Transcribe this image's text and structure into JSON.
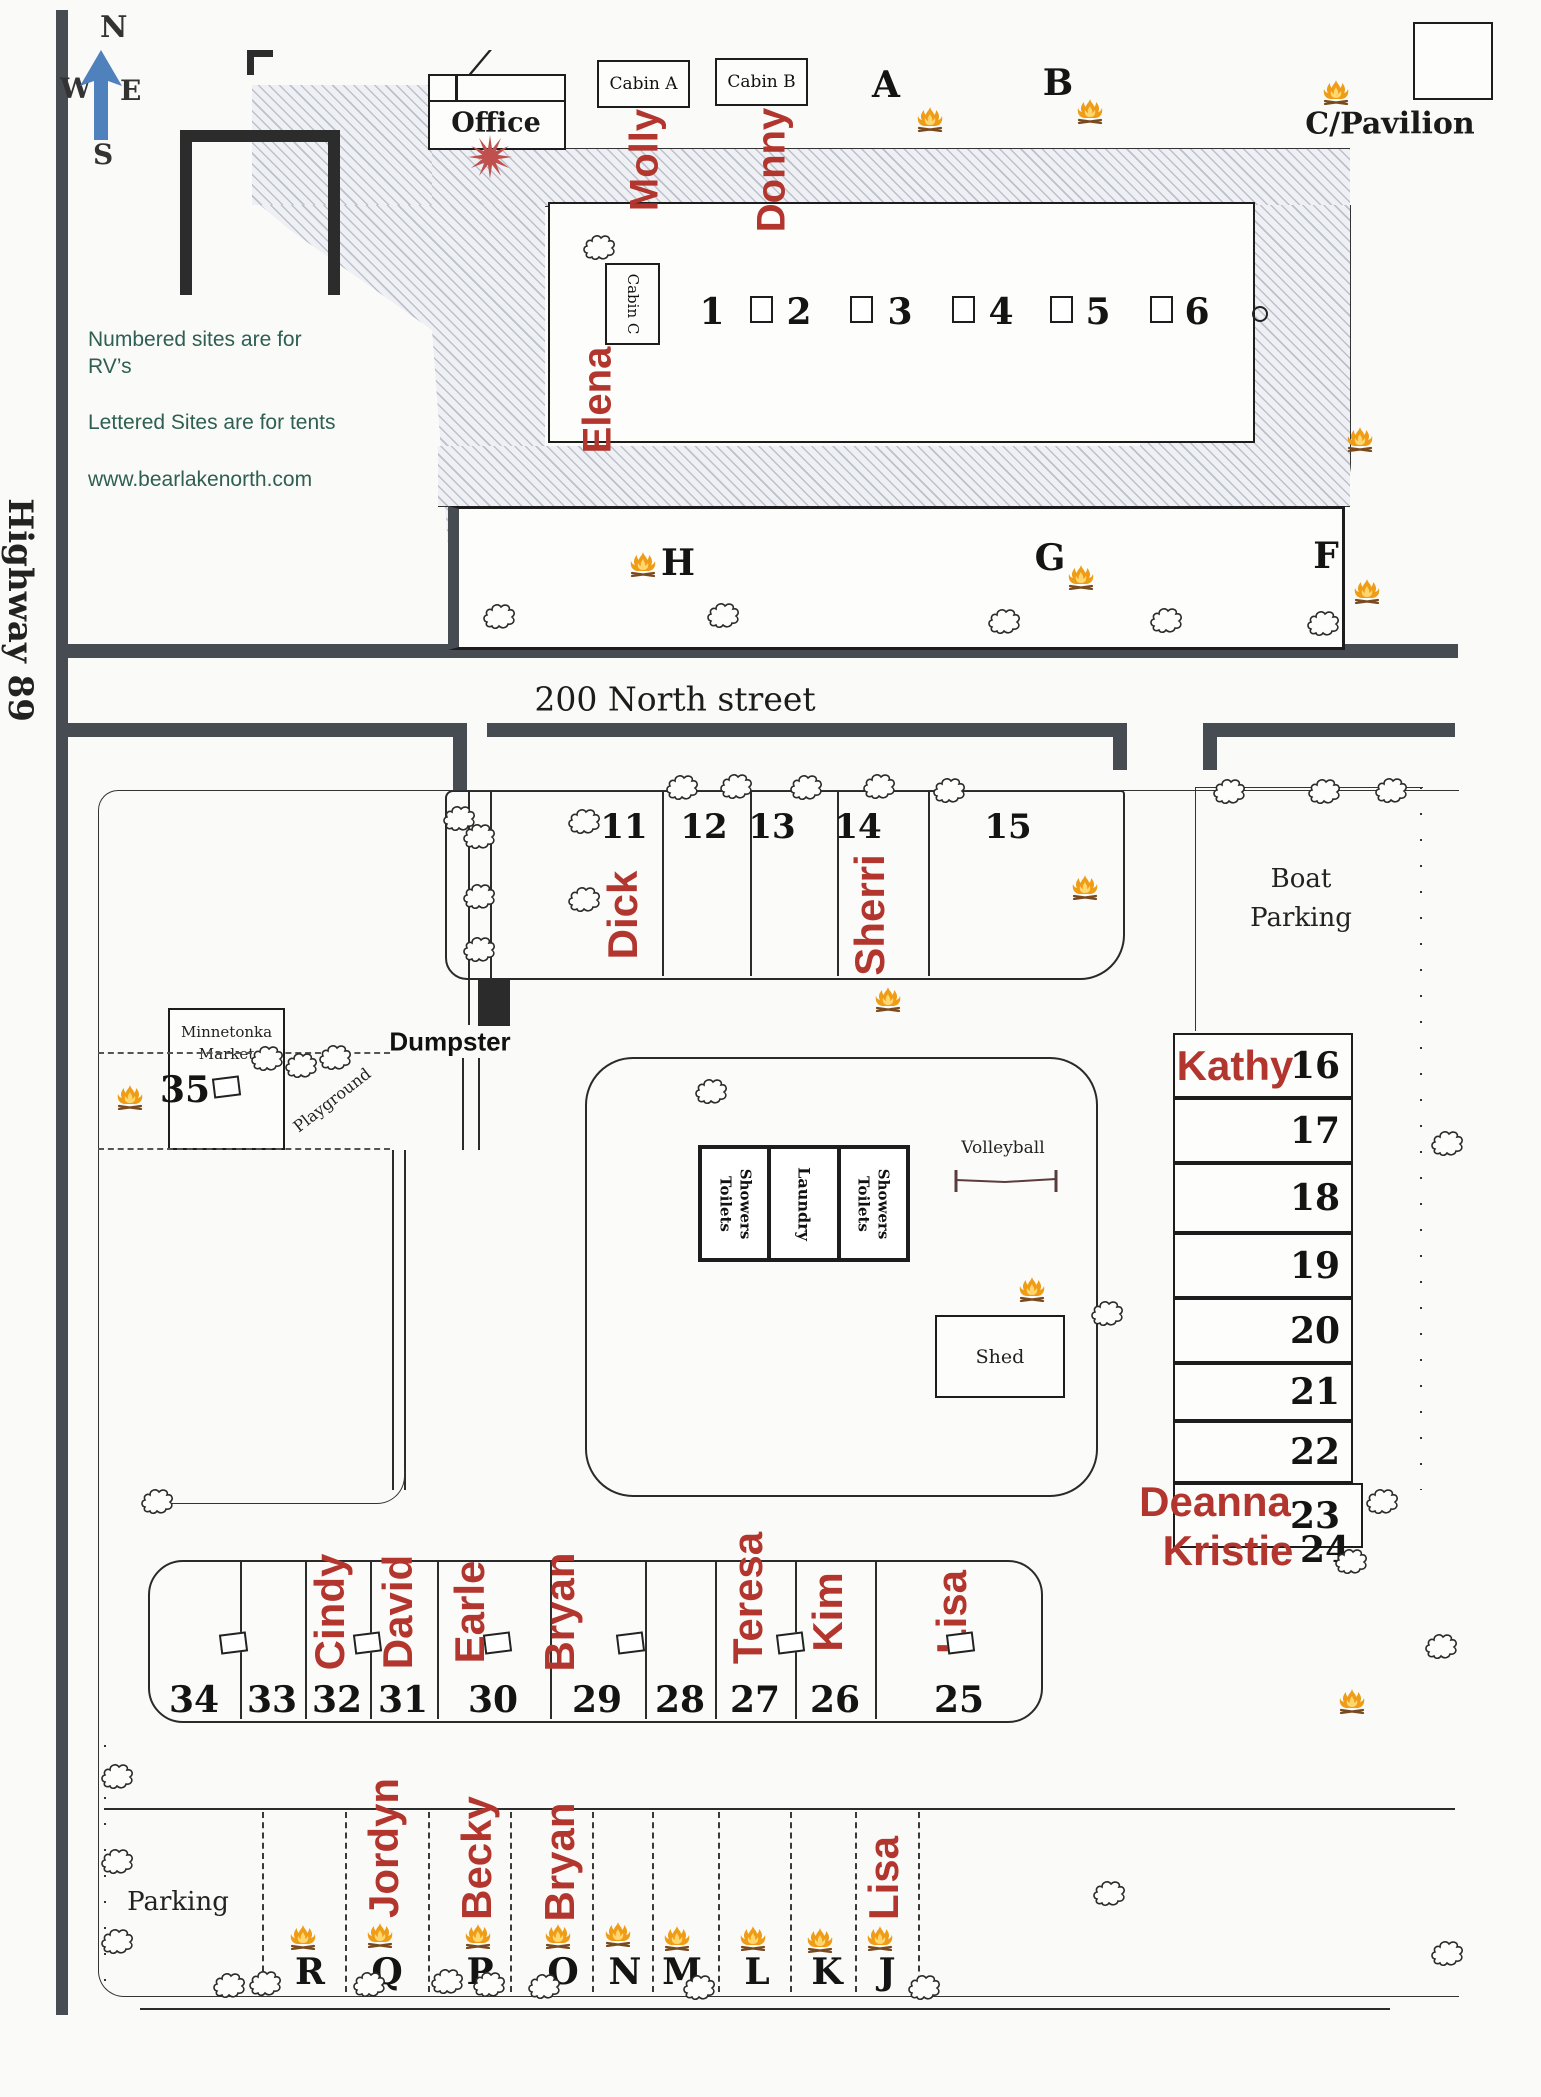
{
  "title": "Bear Lake North campground site map",
  "legend": {
    "line1": "Numbered sites are for RV’s",
    "line2": "Lettered Sites are for tents",
    "website": "www.bearlakenorth.com"
  },
  "compass": {
    "n": "N",
    "s": "S",
    "e": "E",
    "w": "W"
  },
  "roads": {
    "highway": "Highway 89",
    "street": "200 North street"
  },
  "labels": {
    "office": "Office",
    "cabin_a": "Cabin A",
    "cabin_b": "Cabin B",
    "cabin_c": "Cabin C",
    "pavilion": "C/Pavilion",
    "boat1": "Boat",
    "boat2": "Parking",
    "market1": "Minnetonka",
    "market2": "Market",
    "dumpster": "Dumpster",
    "laundry": "Laundry",
    "showers1": "Showers",
    "showers2": "Toilets",
    "volleyball": "Volleyball",
    "shed": "Shed",
    "parking": "Parking",
    "playground": "Playground",
    "site35": "35"
  },
  "colors": {
    "red_name": "#b2362e",
    "starburst": "#c0504d",
    "road_bar": "#474c52",
    "teal_text": "#2e5f52",
    "fire_orange": "#ef9c16",
    "compass_blue": "#4f81bd"
  },
  "cabin_guests": [
    {
      "label": "Molly",
      "x": 645,
      "y": 160
    },
    {
      "label": "Donny",
      "x": 772,
      "y": 170
    },
    {
      "label": "Elena",
      "x": 598,
      "y": 400
    }
  ],
  "rv_sites_1_6": {
    "box": [
      548,
      202,
      1255,
      443
    ],
    "num_y": 312,
    "sites": [
      {
        "num": "1",
        "x": 712
      },
      {
        "num": "2",
        "x": 799,
        "pad_x": 761
      },
      {
        "num": "3",
        "x": 900,
        "pad_x": 861
      },
      {
        "num": "4",
        "x": 1001,
        "pad_x": 963
      },
      {
        "num": "5",
        "x": 1098,
        "pad_x": 1061
      },
      {
        "num": "6",
        "x": 1197,
        "pad_x": 1161
      }
    ],
    "circle_x": 1258
  },
  "tent_sites_top": [
    {
      "letter": "A",
      "x": 886,
      "y": 85
    },
    {
      "letter": "B",
      "x": 1058,
      "y": 83
    }
  ],
  "tent_sites_mid": [
    {
      "letter": "H",
      "x": 678,
      "y": 563
    },
    {
      "letter": "G",
      "x": 1050,
      "y": 558
    },
    {
      "letter": "F",
      "x": 1326,
      "y": 556
    }
  ],
  "rv_strip_11_15": {
    "box": [
      445,
      790,
      1125,
      980
    ],
    "dividers": [
      662,
      750,
      837,
      928
    ],
    "num_y": 827,
    "sites": [
      {
        "num": "11",
        "x": 624,
        "name": "Dick",
        "name_x": 623,
        "name_y": 915
      },
      {
        "num": "12",
        "x": 704
      },
      {
        "num": "13",
        "x": 772
      },
      {
        "num": "14",
        "x": 858,
        "name": "Sherri",
        "name_x": 870,
        "name_y": 915
      },
      {
        "num": "15",
        "x": 1008
      }
    ]
  },
  "rv_right_column": {
    "x1": 1173,
    "x2": 1353,
    "num_x": 1315,
    "sites": [
      {
        "num": "16",
        "y1": 1033,
        "y2": 1098,
        "name": "Kathy",
        "name_x": 1235,
        "name_y": 1066
      },
      {
        "num": "17",
        "y1": 1098,
        "y2": 1163
      },
      {
        "num": "18",
        "y1": 1163,
        "y2": 1233
      },
      {
        "num": "19",
        "y1": 1233,
        "y2": 1298
      },
      {
        "num": "20",
        "y1": 1298,
        "y2": 1363
      },
      {
        "num": "21",
        "y1": 1363,
        "y2": 1421
      },
      {
        "num": "22",
        "y1": 1421,
        "y2": 1483
      },
      {
        "num": "23",
        "y1": 1483,
        "y2": 1548,
        "x2": 1363,
        "name": "Deanna",
        "name_x": 1215,
        "name_y": 1502
      },
      {
        "num": "24",
        "nobox": true,
        "num_x": 1325,
        "num_y": 1550,
        "name": "Kristie",
        "name_x": 1228,
        "name_y": 1551
      }
    ]
  },
  "rv_row_25_34": {
    "box": [
      148,
      1560,
      1043,
      1723
    ],
    "dividers": [
      240,
      305,
      370,
      437,
      550,
      645,
      715,
      795,
      875
    ],
    "num_y": 1700,
    "name_y": 1612,
    "sites": [
      {
        "num": "34",
        "x": 194
      },
      {
        "num": "33",
        "x": 272
      },
      {
        "num": "32",
        "x": 337,
        "name": "Cindy",
        "name_x": 330
      },
      {
        "num": "31",
        "x": 403,
        "name": "David",
        "name_x": 398
      },
      {
        "num": "30",
        "x": 493,
        "name": "Earle",
        "name_x": 470
      },
      {
        "num": "29",
        "x": 597,
        "name": "Bryan",
        "name_x": 560
      },
      {
        "num": "28",
        "x": 680
      },
      {
        "num": "27",
        "x": 755,
        "name": "Teresa",
        "name_x": 748,
        "name_y": 1598
      },
      {
        "num": "26",
        "x": 835,
        "name": "Kim",
        "name_x": 828
      },
      {
        "num": "25",
        "x": 959,
        "name": "Lisa",
        "name_x": 952
      }
    ],
    "posts": [
      [
        233,
        1643
      ],
      [
        367,
        1643
      ],
      [
        497,
        1643
      ],
      [
        630,
        1643
      ],
      [
        790,
        1643
      ],
      [
        960,
        1643
      ]
    ]
  },
  "tent_row_bottom": {
    "letter_y": 1972,
    "dividers": [
      262,
      345,
      428,
      510,
      592,
      652,
      718,
      790,
      855,
      918
    ],
    "sites": [
      {
        "letter": "R",
        "x": 310
      },
      {
        "letter": "Q",
        "x": 387,
        "name": "Jordyn",
        "name_y": 1848
      },
      {
        "letter": "P",
        "x": 480,
        "name": "Becky",
        "name_y": 1858
      },
      {
        "letter": "O",
        "x": 563,
        "name": "Bryan",
        "name_y": 1862
      },
      {
        "letter": "N",
        "x": 625
      },
      {
        "letter": "M",
        "x": 682
      },
      {
        "letter": "L",
        "x": 757
      },
      {
        "letter": "K",
        "x": 827
      },
      {
        "letter": "J",
        "x": 887,
        "name": "Lisa",
        "name_y": 1878
      }
    ]
  },
  "campfires": [
    [
      930,
      120
    ],
    [
      1090,
      112
    ],
    [
      1336,
      93
    ],
    [
      643,
      565
    ],
    [
      1081,
      578
    ],
    [
      1367,
      592
    ],
    [
      1360,
      440
    ],
    [
      1085,
      888
    ],
    [
      888,
      1000
    ],
    [
      130,
      1098
    ],
    [
      1032,
      1290
    ],
    [
      1352,
      1702
    ],
    [
      303,
      1938
    ],
    [
      380,
      1936
    ],
    [
      478,
      1937
    ],
    [
      558,
      1937
    ],
    [
      618,
      1935
    ],
    [
      677,
      1939
    ],
    [
      753,
      1939
    ],
    [
      820,
      1941
    ],
    [
      880,
      1939
    ]
  ],
  "trees": [
    [
      600,
      246
    ],
    [
      500,
      615
    ],
    [
      724,
      614
    ],
    [
      1005,
      620
    ],
    [
      1167,
      619
    ],
    [
      1324,
      622
    ],
    [
      460,
      817
    ],
    [
      585,
      820
    ],
    [
      585,
      898
    ],
    [
      683,
      786
    ],
    [
      737,
      785
    ],
    [
      807,
      786
    ],
    [
      880,
      785
    ],
    [
      950,
      789
    ],
    [
      1230,
      790
    ],
    [
      1325,
      790
    ],
    [
      1392,
      789
    ],
    [
      480,
      835
    ],
    [
      480,
      895
    ],
    [
      480,
      948
    ],
    [
      268,
      1057
    ],
    [
      302,
      1064
    ],
    [
      336,
      1056
    ],
    [
      712,
      1090
    ],
    [
      1108,
      1312
    ],
    [
      1448,
      1142
    ],
    [
      1383,
      1500
    ],
    [
      1352,
      1560
    ],
    [
      1442,
      1645
    ],
    [
      1110,
      1892
    ],
    [
      1448,
      1952
    ],
    [
      118,
      1775
    ],
    [
      118,
      1860
    ],
    [
      118,
      1940
    ],
    [
      158,
      1500
    ],
    [
      230,
      1984
    ],
    [
      266,
      1982
    ],
    [
      370,
      1983
    ],
    [
      448,
      1980
    ],
    [
      490,
      1983
    ],
    [
      545,
      1985
    ],
    [
      700,
      1986
    ],
    [
      925,
      1986
    ]
  ],
  "rock_circles": [
    [
      358,
      893,
      20
    ],
    [
      367,
      932,
      13
    ],
    [
      370,
      962,
      10
    ]
  ]
}
